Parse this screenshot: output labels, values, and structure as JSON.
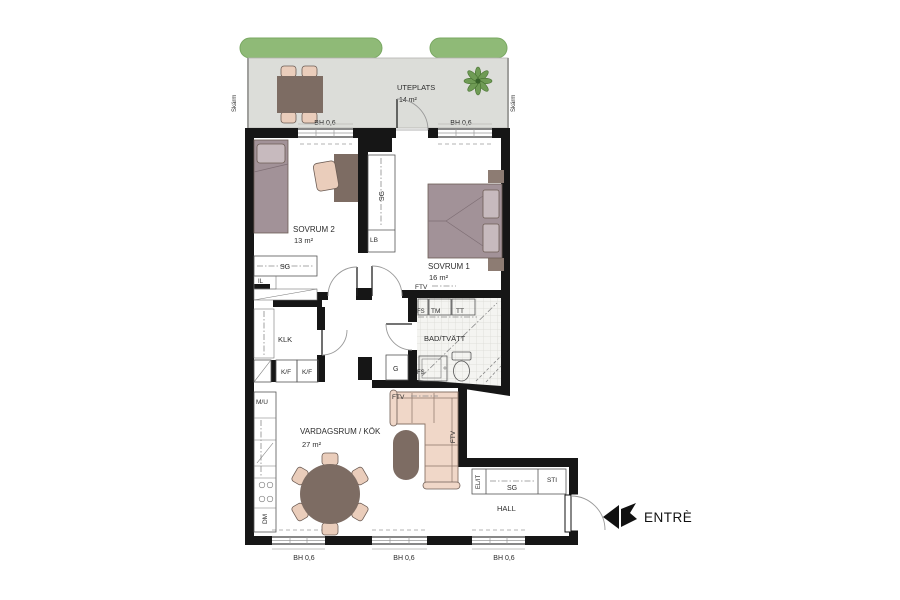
{
  "plan": {
    "outdoor": {
      "name": "UTEPLATS",
      "area": "14 m²",
      "screen_left": "Skärm",
      "screen_right": "Skärm"
    },
    "rooms": {
      "sovrum2": {
        "name": "SOVRUM 2",
        "area": "13 m²"
      },
      "sovrum1": {
        "name": "SOVRUM 1",
        "area": "16 m²"
      },
      "bad": {
        "name": "BAD/TVÄTT"
      },
      "klk": {
        "name": "KLK"
      },
      "vardagsrum": {
        "name": "VARDAGSRUM / KÖK",
        "area": "27 m²"
      },
      "hall": {
        "name": "HALL"
      }
    },
    "fixtures": {
      "sg": "SG",
      "lb": "LB",
      "il": "IL",
      "kf": "K/F",
      "mu": "M/U",
      "dm": "DM",
      "g": "G",
      "fs": "FS",
      "tm": "TM",
      "tt": "TT",
      "ftv": "FTV",
      "elit": "EL/IT",
      "sti": "STI",
      "bh": "BH 0,6"
    },
    "entrance": {
      "label": "ENTRÈ"
    },
    "colors": {
      "wall": "#161616",
      "hedge": "#8fba77",
      "patio_floor": "#dcddd9",
      "furniture_brown": "#7d6c63",
      "chair_tan": "#eacdbb",
      "bed_mauve": "#a29298",
      "pillow": "#c7babe",
      "sofa_pink": "#f0d7c8",
      "plant_green": "#6f9b55",
      "nightstand": "#8d7c73",
      "tile_line": "#dfdfda"
    }
  }
}
